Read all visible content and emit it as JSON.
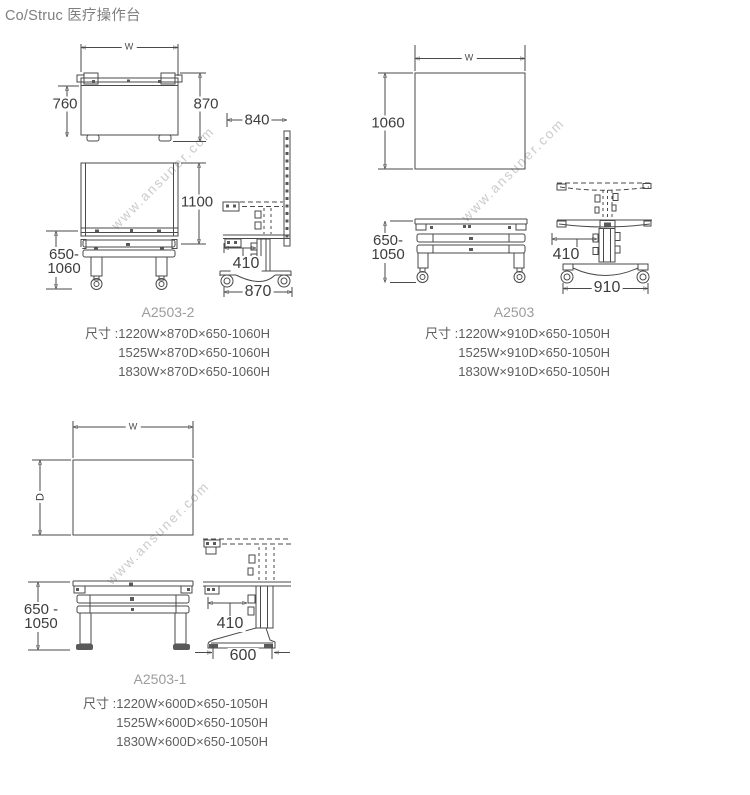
{
  "page": {
    "title": "Co/Struc 医疗操作台",
    "watermark": "www.ansuner.com"
  },
  "groups": [
    {
      "model": "A2503-2",
      "size_label": "尺寸 : ",
      "sizes": [
        "1220W×870D×650-1060H",
        "1525W×870D×650-1060H",
        "1830W×870D×650-1060H"
      ],
      "dims": {
        "w": "W",
        "top_depth": "760",
        "full_depth": "870",
        "side_depth": "840",
        "board_height": "1100",
        "height_range": [
          "650-",
          "1060"
        ],
        "reach": "410",
        "base_depth": "870"
      }
    },
    {
      "model": "A2503",
      "size_label": "尺寸 : ",
      "sizes": [
        "1220W×910D×650-1050H",
        "1525W×910D×650-1050H",
        "1830W×910D×650-1050H"
      ],
      "dims": {
        "w": "W",
        "top_depth": "1060",
        "height_range": [
          "650-",
          "1050"
        ],
        "reach": "410",
        "base_depth": "910"
      }
    },
    {
      "model": "A2503-1",
      "size_label": "尺寸 : ",
      "sizes": [
        "1220W×600D×650-1050H",
        "1525W×600D×650-1050H",
        "1830W×600D×650-1050H"
      ],
      "dims": {
        "w": "W",
        "top_depth": "D",
        "height_range": [
          "650 -",
          "1050"
        ],
        "reach": "410",
        "base_depth": "600"
      }
    }
  ]
}
